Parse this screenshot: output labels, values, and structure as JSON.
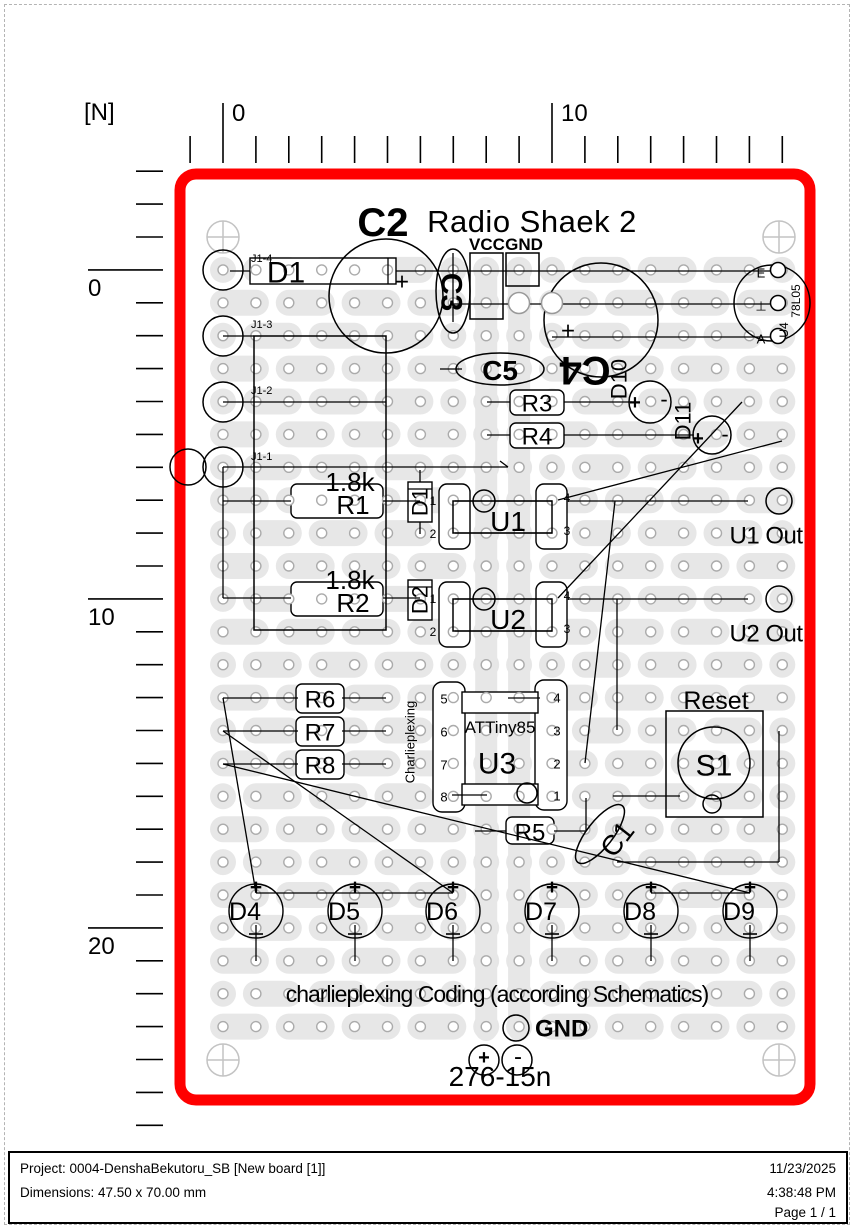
{
  "footer": {
    "project": "Project: 0004-DenshaBekutoru_SB [New board [1]]",
    "dimensions": "Dimensions: 47.50 x 70.00 mm",
    "date": "11/23/2025",
    "time": "4:38:48 PM",
    "page": "Page 1 / 1"
  },
  "ruler": {
    "unit_label": "[N]",
    "top": {
      "from": -1,
      "to": 17,
      "majors": [
        {
          "n": 0,
          "label": "0"
        },
        {
          "n": 10,
          "label": "10"
        }
      ],
      "minor_y1": 136,
      "minor_y2": 163,
      "major_y1": 103
    },
    "left": {
      "from": -3,
      "to": 26,
      "majors": [
        {
          "k": 0,
          "label": "0"
        },
        {
          "k": 10,
          "label": "10"
        },
        {
          "k": 20,
          "label": "20"
        }
      ],
      "minor_x1": 136,
      "minor_x2": 163,
      "major_x1": 88
    }
  },
  "colors": {
    "board_outline": "#ff0000",
    "strip": "#e7e7e7",
    "hole_ring": "#ababab",
    "crosshair": "#c3c3c3",
    "wire": "#000000"
  },
  "grid": {
    "x0": 223,
    "y0": 237,
    "pitch": 32.9,
    "cols": 18,
    "row_start": 1,
    "row_end": 24,
    "hole_r": 5,
    "pad_r": 13,
    "bus_cols": [
      8,
      9
    ],
    "bus_y1": 258,
    "bus_y2": 1041
  },
  "board_frame": {
    "x": 180,
    "y": 174,
    "w": 630,
    "h": 926,
    "rx": 16,
    "sw": 11
  },
  "crosshairs": [
    [
      223,
      237
    ],
    [
      779,
      237
    ],
    [
      223,
      1060
    ],
    [
      779,
      1060
    ]
  ],
  "under_shapes": [
    {
      "k": "r",
      "n": "diode-d1-body",
      "x": 250,
      "y": 258,
      "w": 146,
      "h": 26
    },
    {
      "k": "r",
      "n": "resistor-r1-body",
      "x": 291,
      "y": 484,
      "w": 92,
      "h": 34,
      "rx": 6
    },
    {
      "k": "r",
      "n": "resistor-r2-body",
      "x": 291,
      "y": 582,
      "w": 92,
      "h": 34,
      "rx": 6
    },
    {
      "k": "r",
      "n": "resistor-r3-body",
      "x": 510,
      "y": 390,
      "w": 54,
      "h": 25,
      "rx": 6
    },
    {
      "k": "r",
      "n": "resistor-r4-body",
      "x": 510,
      "y": 423,
      "w": 54,
      "h": 25,
      "rx": 6
    },
    {
      "k": "r",
      "n": "resistor-r5-body",
      "x": 506,
      "y": 817,
      "w": 48,
      "h": 27,
      "rx": 6
    },
    {
      "k": "r",
      "n": "resistor-r6-body",
      "x": 296,
      "y": 684,
      "w": 48,
      "h": 29,
      "rx": 6
    },
    {
      "k": "r",
      "n": "resistor-r7-body",
      "x": 296,
      "y": 717,
      "w": 48,
      "h": 29,
      "rx": 6
    },
    {
      "k": "r",
      "n": "resistor-r8-body",
      "x": 296,
      "y": 750,
      "w": 48,
      "h": 29,
      "rx": 6
    },
    {
      "k": "r",
      "n": "diode-d1v-body",
      "x": 408,
      "y": 482,
      "w": 24,
      "h": 40
    },
    {
      "k": "r",
      "n": "diode-d2v-body",
      "x": 408,
      "y": 580,
      "w": 24,
      "h": 40
    },
    {
      "k": "r",
      "n": "ic-u1-pinbox",
      "x": 439,
      "y": 484,
      "w": 31,
      "h": 65,
      "rx": 8
    },
    {
      "k": "r",
      "n": "ic-u1-pinbox",
      "x": 536,
      "y": 484,
      "w": 31,
      "h": 65,
      "rx": 8
    },
    {
      "k": "r",
      "n": "ic-u2-pinbox",
      "x": 439,
      "y": 582,
      "w": 31,
      "h": 65,
      "rx": 8
    },
    {
      "k": "r",
      "n": "ic-u2-pinbox",
      "x": 536,
      "y": 582,
      "w": 31,
      "h": 65,
      "rx": 8
    },
    {
      "k": "r",
      "n": "ic-u3-pinbox",
      "x": 433,
      "y": 682,
      "w": 32,
      "h": 130,
      "rx": 9
    },
    {
      "k": "r",
      "n": "ic-u3-pinbox",
      "x": 535,
      "y": 680,
      "w": 32,
      "h": 130,
      "rx": 9
    },
    {
      "k": "r",
      "n": "ic-u3-toprect",
      "x": 462,
      "y": 692,
      "w": 76,
      "h": 21
    },
    {
      "k": "r",
      "n": "ic-u3-botrect",
      "x": 462,
      "y": 784,
      "w": 76,
      "h": 21
    }
  ],
  "wires": [
    [
      230,
      271,
      250,
      271
    ],
    [
      396,
      271,
      770,
      271
    ],
    [
      388,
      258,
      388,
      284
    ],
    [
      453,
      253,
      453,
      322
    ],
    [
      453,
      304,
      770,
      304
    ],
    [
      552,
      337,
      770,
      337
    ],
    [
      440,
      369,
      462,
      369
    ],
    [
      487,
      402,
      510,
      402
    ],
    [
      564,
      402,
      632,
      402
    ],
    [
      487,
      435,
      510,
      435
    ],
    [
      564,
      435,
      694,
      435
    ],
    [
      223,
      336,
      254,
      336
    ],
    [
      223,
      402,
      386,
      402
    ],
    [
      223,
      467,
      508,
      467
    ],
    [
      508,
      467,
      500,
      461
    ],
    [
      223,
      467,
      223,
      598
    ],
    [
      223,
      501,
      291,
      501
    ],
    [
      383,
      501,
      420,
      501
    ],
    [
      223,
      598,
      291,
      598
    ],
    [
      383,
      598,
      420,
      598
    ],
    [
      420,
      470,
      420,
      482
    ],
    [
      420,
      522,
      420,
      534
    ],
    [
      408,
      489,
      432,
      489
    ],
    [
      408,
      587,
      432,
      587
    ],
    [
      455,
      501,
      552,
      501
    ],
    [
      455,
      533,
      552,
      533
    ],
    [
      455,
      599,
      552,
      599
    ],
    [
      455,
      631,
      552,
      631
    ],
    [
      568,
      501,
      748,
      501
    ],
    [
      568,
      599,
      748,
      599
    ],
    [
      508,
      698,
      540,
      698
    ],
    [
      452,
      795,
      487,
      795
    ],
    [
      475,
      831,
      506,
      831
    ],
    [
      554,
      831,
      586,
      831
    ],
    [
      586,
      798,
      586,
      831
    ],
    [
      613,
      796,
      680,
      796
    ],
    [
      779,
      731,
      779,
      862
    ],
    [
      617,
      862,
      779,
      862
    ],
    [
      223,
      698,
      298,
      698
    ],
    [
      342,
      698,
      386,
      698
    ],
    [
      223,
      731,
      298,
      731
    ],
    [
      342,
      731,
      386,
      731
    ],
    [
      223,
      764,
      298,
      764
    ],
    [
      342,
      764,
      386,
      764
    ],
    [
      256,
      893,
      453,
      893
    ],
    [
      651,
      893,
      750,
      893
    ],
    [
      558,
      500,
      782,
      441
    ],
    [
      558,
      598,
      742,
      402
    ],
    [
      615,
      501,
      585,
      763
    ],
    [
      617,
      599,
      617,
      730
    ],
    [
      223,
      698,
      256,
      893
    ],
    [
      223,
      731,
      453,
      893
    ],
    [
      223,
      764,
      750,
      893
    ]
  ],
  "over_shapes": [
    {
      "k": "c",
      "n": "pad-j1-4",
      "cx": 223,
      "cy": 270,
      "r": 20
    },
    {
      "k": "c",
      "n": "pad-j1-3",
      "cx": 223,
      "cy": 336,
      "r": 20
    },
    {
      "k": "c",
      "n": "pad-j1-2",
      "cx": 223,
      "cy": 402,
      "r": 20
    },
    {
      "k": "c",
      "n": "pad-j1-1",
      "cx": 223,
      "cy": 467,
      "r": 20
    },
    {
      "k": "c",
      "n": "pad",
      "cx": 188,
      "cy": 467,
      "r": 18
    },
    {
      "k": "c",
      "n": "capacitor-c2",
      "cx": 386,
      "cy": 296,
      "r": 57
    },
    {
      "k": "c",
      "n": "capacitor-c4",
      "cx": 601,
      "cy": 320,
      "r": 57
    },
    {
      "k": "e",
      "n": "capacitor-c3",
      "cx": 453,
      "cy": 291,
      "rx": 17,
      "ry": 42
    },
    {
      "k": "e",
      "n": "capacitor-c5",
      "cx": 500,
      "cy": 369,
      "rx": 44,
      "ry": 16
    },
    {
      "k": "e",
      "n": "capacitor-c1",
      "cx": 600,
      "cy": 834,
      "rx": 13,
      "ry": 36,
      "rot": 38
    },
    {
      "k": "c",
      "n": "regulator-u4-body",
      "cx": 772,
      "cy": 303,
      "r": 38
    },
    {
      "k": "c",
      "n": "regulator-u4-pad",
      "cx": 778,
      "cy": 270,
      "r": 7.5,
      "f": "#ffffff"
    },
    {
      "k": "c",
      "n": "regulator-u4-pad",
      "cx": 778,
      "cy": 303,
      "r": 7.5,
      "f": "#ffffff"
    },
    {
      "k": "c",
      "n": "regulator-u4-pad",
      "cx": 778,
      "cy": 336,
      "r": 7.5,
      "f": "#ffffff"
    },
    {
      "k": "c",
      "n": "via-hole",
      "cx": 519,
      "cy": 303,
      "r": 10.5,
      "f": "#ffffff",
      "st": "#999999"
    },
    {
      "k": "c",
      "n": "via-hole",
      "cx": 552,
      "cy": 303,
      "r": 10.5,
      "f": "#ffffff",
      "st": "#999999"
    },
    {
      "k": "r",
      "n": "vcc-pad",
      "x": 470,
      "y": 253,
      "w": 33,
      "h": 66
    },
    {
      "k": "r",
      "n": "gnd-pad",
      "x": 506,
      "y": 253,
      "w": 33,
      "h": 33
    },
    {
      "k": "r",
      "n": "connector-j1-outline",
      "x": 254,
      "y": 336,
      "w": 132,
      "h": 294
    },
    {
      "k": "r",
      "n": "ic-u1-inner",
      "x": 453,
      "y": 501,
      "w": 99,
      "h": 32
    },
    {
      "k": "c",
      "n": "ic-u1-dot",
      "cx": 484,
      "cy": 501,
      "r": 11
    },
    {
      "k": "r",
      "n": "ic-u2-inner",
      "x": 453,
      "y": 599,
      "w": 99,
      "h": 32
    },
    {
      "k": "c",
      "n": "ic-u2-dot",
      "cx": 484,
      "cy": 599,
      "r": 11
    },
    {
      "k": "c",
      "n": "ic-u3-dot",
      "cx": 527,
      "cy": 793,
      "r": 10
    },
    {
      "k": "c",
      "n": "led-d10",
      "cx": 650,
      "cy": 402,
      "r": 21
    },
    {
      "k": "c",
      "n": "led-d11",
      "cx": 712,
      "cy": 435,
      "r": 19
    },
    {
      "k": "c",
      "n": "u1-out-pad",
      "cx": 779,
      "cy": 501,
      "r": 13
    },
    {
      "k": "c",
      "n": "u2-out-pad",
      "cx": 779,
      "cy": 599,
      "r": 13
    },
    {
      "k": "r",
      "n": "switch-s1-outline",
      "x": 666,
      "y": 711,
      "w": 97,
      "h": 106
    },
    {
      "k": "c",
      "n": "switch-s1-body",
      "cx": 714,
      "cy": 763,
      "r": 36
    },
    {
      "k": "c",
      "n": "switch-s1-pin",
      "cx": 712,
      "cy": 804,
      "r": 9
    },
    {
      "k": "c",
      "n": "gnd-bottom-pad",
      "cx": 516,
      "cy": 1028,
      "r": 13
    },
    {
      "k": "c",
      "n": "power-pad-plus",
      "cx": 484,
      "cy": 1060,
      "r": 15
    },
    {
      "k": "c",
      "n": "power-pad-minus",
      "cx": 517,
      "cy": 1060,
      "r": 15
    }
  ],
  "leds": {
    "y": 911,
    "r": 27,
    "stem_y1": 925,
    "stem_y2": 961,
    "items": [
      {
        "x": 256,
        "label": "D4"
      },
      {
        "x": 355,
        "label": "D5"
      },
      {
        "x": 453,
        "label": "D6"
      },
      {
        "x": 552,
        "label": "D7"
      },
      {
        "x": 651,
        "label": "D8"
      },
      {
        "x": 750,
        "label": "D9"
      }
    ]
  },
  "texts": [
    {
      "x": 383,
      "y": 222,
      "t": "C2",
      "s": 40,
      "fw": 700,
      "n": "c2-label"
    },
    {
      "x": 532,
      "y": 221,
      "t": "Radio Shaek 2",
      "s": 31,
      "ls": 0.5,
      "n": "board-title"
    },
    {
      "x": 487,
      "y": 244,
      "t": "VCC",
      "s": 17,
      "fw": 700,
      "n": "vcc-label"
    },
    {
      "x": 524,
      "y": 244,
      "t": "GND",
      "s": 17,
      "fw": 700,
      "n": "gnd-top-label"
    },
    {
      "x": 452,
      "y": 292,
      "t": "C3",
      "s": 30,
      "fw": 700,
      "rot": 90,
      "n": "c3-label"
    },
    {
      "x": 585,
      "y": 371,
      "t": "C4",
      "s": 40,
      "fw": 700,
      "rot": 180,
      "n": "c4-label"
    },
    {
      "x": 500,
      "y": 370,
      "t": "C5",
      "s": 28,
      "fw": 700,
      "n": "c5-label"
    },
    {
      "x": 286,
      "y": 272,
      "t": "D1",
      "s": 30,
      "n": "d1-label"
    },
    {
      "x": 251,
      "y": 258,
      "t": "J1-4",
      "s": 11,
      "an": "s",
      "n": "j1-4-label"
    },
    {
      "x": 251,
      "y": 324,
      "t": "J1-3",
      "s": 11,
      "an": "s",
      "n": "j1-3-label"
    },
    {
      "x": 251,
      "y": 390,
      "t": "J1-2",
      "s": 11,
      "an": "s",
      "n": "j1-2-label"
    },
    {
      "x": 251,
      "y": 456,
      "t": "J1-1",
      "s": 11,
      "an": "s",
      "n": "j1-1-label"
    },
    {
      "x": 402,
      "y": 281,
      "t": "+",
      "s": 24,
      "n": "c2-plus"
    },
    {
      "x": 568,
      "y": 330,
      "t": "+",
      "s": 24,
      "n": "c4-plus"
    },
    {
      "x": 761,
      "y": 273,
      "t": "E",
      "s": 13,
      "n": "u4-pin-e"
    },
    {
      "x": 761,
      "y": 306,
      "t": "⊥",
      "s": 13,
      "n": "u4-pin-gnd"
    },
    {
      "x": 761,
      "y": 339,
      "t": "A",
      "s": 13,
      "n": "u4-pin-a"
    },
    {
      "x": 796,
      "y": 301,
      "t": "78L05",
      "s": 12,
      "rot": -90,
      "n": "u4-part-label"
    },
    {
      "x": 784,
      "y": 330,
      "t": "U4",
      "s": 12,
      "rot": -90,
      "n": "u4-label"
    },
    {
      "x": 537,
      "y": 403,
      "t": "R3",
      "s": 24,
      "n": "r3-label"
    },
    {
      "x": 537,
      "y": 436,
      "t": "R4",
      "s": 24,
      "n": "r4-label"
    },
    {
      "x": 619,
      "y": 379,
      "t": "D10",
      "s": 22,
      "rot": -90,
      "n": "d10-label"
    },
    {
      "x": 635,
      "y": 402,
      "t": "+",
      "s": 20,
      "fw": 700
    },
    {
      "x": 664,
      "y": 399,
      "t": "-",
      "s": 22
    },
    {
      "x": 683,
      "y": 421,
      "t": "D11",
      "s": 22,
      "rot": -90,
      "n": "d11-label"
    },
    {
      "x": 698,
      "y": 438,
      "t": "+",
      "s": 20,
      "fw": 700
    },
    {
      "x": 725,
      "y": 434,
      "t": "-",
      "s": 22
    },
    {
      "x": 350,
      "y": 482,
      "t": "1.8k",
      "s": 26,
      "n": "r1-value"
    },
    {
      "x": 353,
      "y": 505,
      "t": "R1",
      "s": 26,
      "n": "r1-label"
    },
    {
      "x": 350,
      "y": 580,
      "t": "1.8k",
      "s": 26,
      "n": "r2-value"
    },
    {
      "x": 353,
      "y": 603,
      "t": "R2",
      "s": 26,
      "n": "r2-label"
    },
    {
      "x": 420,
      "y": 502,
      "t": "D1",
      "s": 22,
      "rot": -90,
      "n": "d1v-label"
    },
    {
      "x": 420,
      "y": 600,
      "t": "D2",
      "s": 22,
      "rot": -90,
      "n": "d2v-label"
    },
    {
      "x": 508,
      "y": 521,
      "t": "U1",
      "s": 28,
      "n": "u1-label"
    },
    {
      "x": 508,
      "y": 619,
      "t": "U2",
      "s": 28,
      "n": "u2-label"
    },
    {
      "x": 433,
      "y": 501,
      "t": "1",
      "s": 12
    },
    {
      "x": 433,
      "y": 534,
      "t": "2",
      "s": 12
    },
    {
      "x": 567,
      "y": 498,
      "t": "4",
      "s": 12
    },
    {
      "x": 567,
      "y": 531,
      "t": "3",
      "s": 12
    },
    {
      "x": 433,
      "y": 599,
      "t": "1",
      "s": 12
    },
    {
      "x": 433,
      "y": 632,
      "t": "2",
      "s": 12
    },
    {
      "x": 567,
      "y": 596,
      "t": "4",
      "s": 12
    },
    {
      "x": 567,
      "y": 629,
      "t": "3",
      "s": 12
    },
    {
      "x": 766,
      "y": 535,
      "t": "U1 Out",
      "s": 24,
      "ls": -0.5,
      "n": "u1-out-label"
    },
    {
      "x": 766,
      "y": 633,
      "t": "U2 Out",
      "s": 24,
      "ls": -0.5,
      "n": "u2-out-label"
    },
    {
      "x": 500,
      "y": 727,
      "t": "ATTiny85",
      "s": 17,
      "n": "u3-part-label"
    },
    {
      "x": 497,
      "y": 763,
      "t": "U3",
      "s": 30,
      "n": "u3-label"
    },
    {
      "x": 410,
      "y": 742,
      "t": "Charlieplexing",
      "s": 13,
      "rot": -90,
      "n": "charlieplexing-label"
    },
    {
      "x": 444,
      "y": 699,
      "t": "5",
      "s": 13
    },
    {
      "x": 444,
      "y": 732,
      "t": "6",
      "s": 13
    },
    {
      "x": 444,
      "y": 765,
      "t": "7",
      "s": 13
    },
    {
      "x": 444,
      "y": 797,
      "t": "8",
      "s": 13
    },
    {
      "x": 557,
      "y": 698,
      "t": "4",
      "s": 13
    },
    {
      "x": 557,
      "y": 731,
      "t": "3",
      "s": 13
    },
    {
      "x": 557,
      "y": 764,
      "t": "2",
      "s": 13
    },
    {
      "x": 557,
      "y": 796,
      "t": "1",
      "s": 13
    },
    {
      "x": 530,
      "y": 832,
      "t": "R5",
      "s": 24,
      "n": "r5-label"
    },
    {
      "x": 617,
      "y": 839,
      "t": "C1",
      "s": 28,
      "rot": -52,
      "n": "c1-label"
    },
    {
      "x": 716,
      "y": 700,
      "t": "Reset",
      "s": 25,
      "n": "reset-label"
    },
    {
      "x": 714,
      "y": 765,
      "t": "S1",
      "s": 30,
      "n": "s1-label"
    },
    {
      "x": 320,
      "y": 699,
      "t": "R6",
      "s": 24,
      "n": "r6-label"
    },
    {
      "x": 320,
      "y": 732,
      "t": "R7",
      "s": 24,
      "n": "r7-label"
    },
    {
      "x": 320,
      "y": 765,
      "t": "R8",
      "s": 24,
      "n": "r8-label"
    },
    {
      "x": 497,
      "y": 994,
      "t": "charlieplexing Coding (according Schematics)",
      "s": 23,
      "ls": -1,
      "n": "caption"
    },
    {
      "x": 535,
      "y": 1028,
      "t": "GND",
      "s": 24,
      "fw": 700,
      "an": "s",
      "n": "gnd-bottom-label"
    },
    {
      "x": 500,
      "y": 1076,
      "t": "276-15n",
      "s": 28,
      "n": "part-number"
    },
    {
      "x": 484,
      "y": 1057,
      "t": "+",
      "s": 20,
      "fw": 700
    },
    {
      "x": 518,
      "y": 1056,
      "t": "-",
      "s": 24
    }
  ]
}
